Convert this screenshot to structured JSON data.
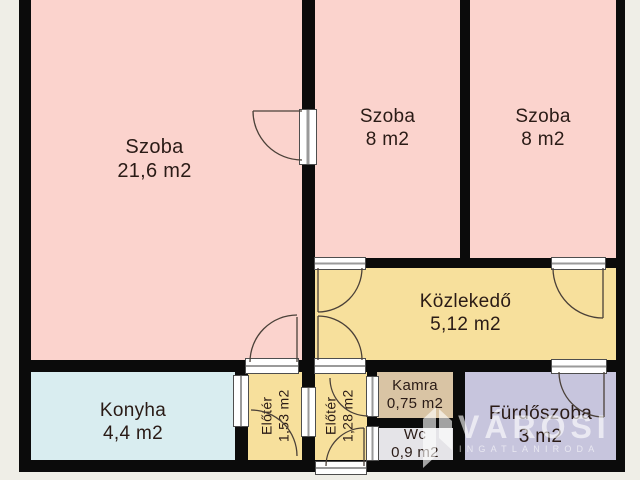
{
  "plan": {
    "type": "floor-plan",
    "language": "hu",
    "palette": {
      "background": "#efeee7",
      "wall": "#0b0b0b",
      "room_pink": "#fbd3cd",
      "hall_yellow": "#f7e09c",
      "kitchen_blue": "#d9edf0",
      "pantry_tan": "#d9c4a4",
      "wc_gray": "#e5e4e8",
      "bathroom_lavender": "#c7c5dd",
      "label_text": "#2a1b16",
      "watermark_white": "#ffffff"
    },
    "rooms": [
      {
        "name": "Szoba",
        "area": "21,6 m2"
      },
      {
        "name": "Szoba",
        "area": "8 m2"
      },
      {
        "name": "Szoba",
        "area": "8 m2"
      },
      {
        "name": "Közlekedő",
        "area": "5,12 m2"
      },
      {
        "name": "Konyha",
        "area": "4,4 m2"
      },
      {
        "name": "Előtér",
        "area": "1,53 m2"
      },
      {
        "name": "Előtér",
        "area": "1,28 m2"
      },
      {
        "name": "Kamra",
        "area": "0,75 m2"
      },
      {
        "name": "Wc",
        "area": "0,9 m2"
      },
      {
        "name": "Fürdőszoba",
        "area": "3 m2"
      }
    ],
    "watermark": {
      "brand": "VÁROSI",
      "tagline": "INGATLANIRODA"
    }
  }
}
